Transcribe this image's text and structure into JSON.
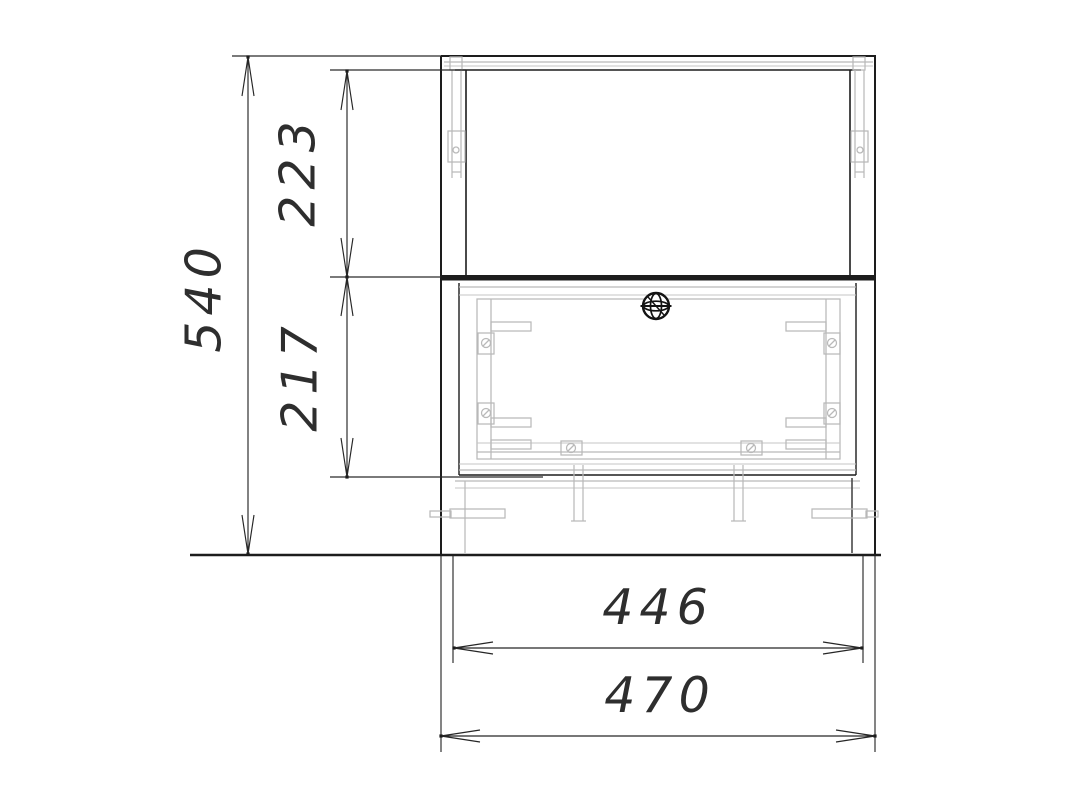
{
  "drawing": {
    "type": "furniture-cabinet-front-elevation",
    "units": "mm",
    "background_color": "#ffffff",
    "line_color": "#1d1d1d",
    "hardware_line_color": "#b9b9b9",
    "dimension_text_color": "#2e2e2e",
    "dimensions": {
      "overall_height": "540",
      "top_section_height": "223",
      "bottom_section_height": "217",
      "inner_width": "446",
      "overall_width": "470"
    },
    "icons": {
      "door_knob": "wireframe-sphere-knob-icon"
    }
  }
}
